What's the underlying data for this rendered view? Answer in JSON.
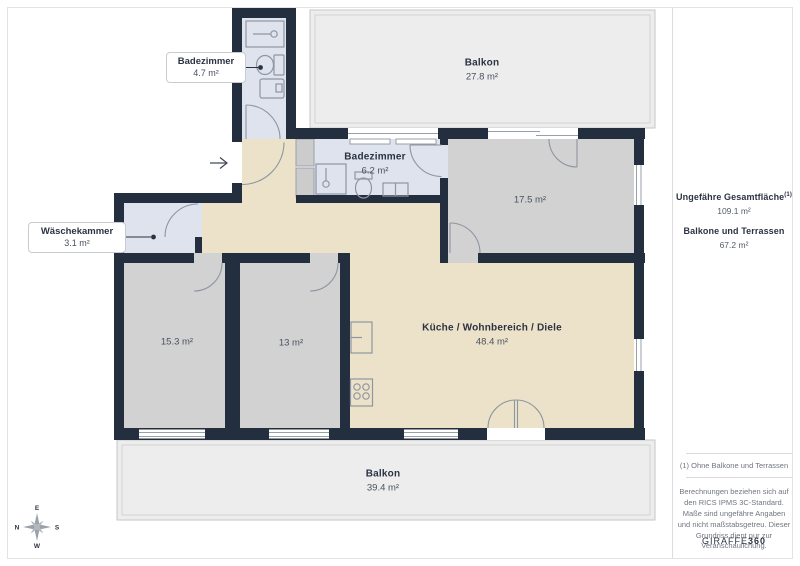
{
  "colors": {
    "wall": "#232e3f",
    "bathroom_floor": "#dee3ee",
    "bedroom_floor": "#d2d2d2",
    "living_floor": "#ece2c9",
    "balcony_floor": "#ededed",
    "label_text": "#2b3342",
    "muted_text": "#49525f"
  },
  "rooms": {
    "balkon_oben": {
      "name": "Balkon",
      "area": "27.8 m²"
    },
    "badezimmer_klein": {
      "name": "Badezimmer",
      "area": "4.7 m²"
    },
    "badezimmer": {
      "name": "Badezimmer",
      "area": "6.2 m²"
    },
    "waeschekammer": {
      "name": "Wäschekammer",
      "area": "3.1 m²"
    },
    "zimmer_gross": {
      "area": "17.5 m²"
    },
    "zimmer_links": {
      "area": "15.3 m²"
    },
    "zimmer_mitte": {
      "area": "13 m²"
    },
    "wohnbereich": {
      "name": "Küche / Wohnbereich / Diele",
      "area": "48.4 m²"
    },
    "balkon_unten": {
      "name": "Balkon",
      "area": "39.4 m²"
    }
  },
  "compass": {
    "top": "E",
    "left": "N",
    "right": "S",
    "bottom": "W"
  },
  "sidebar": {
    "total_label": "Ungefähre Gesamtfläche",
    "total_footnote_marker": "(1)",
    "total_value": "109.1 m²",
    "balconies_label": "Balkone und Terrassen",
    "balconies_value": "67.2 m²",
    "footnote": "(1) Ohne Balkone und Terrassen",
    "disclaimer": "Berechnungen beziehen sich auf den RICS IPMS 3C-Standard. Maße sind ungefähre Angaben und nicht maßstabsgetreu. Dieser Grundriss dient nur zur Veranschaulichung.",
    "brand_name": "GIRAFFE",
    "brand_suffix": "360"
  }
}
